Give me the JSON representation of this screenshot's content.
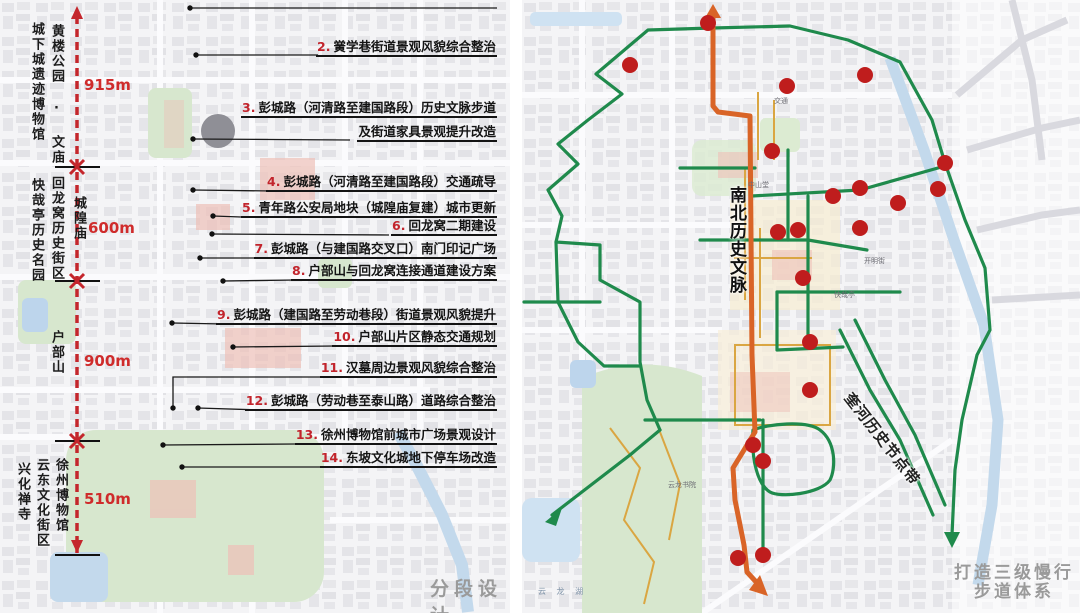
{
  "left_panel": {
    "caption": "分段设计",
    "segments": [
      {
        "label": "915m"
      },
      {
        "label": "600m"
      },
      {
        "label": "900m"
      },
      {
        "label": "510m"
      }
    ],
    "side_labels": [
      "城下城遗迹博物馆",
      "黄楼公园 · 文庙",
      "快哉亭历史名园",
      "回龙窝历史街区",
      "城隍庙",
      "户部山",
      "兴化禅寺",
      "云东文化街区",
      "徐州博物馆"
    ],
    "annotations": [
      {
        "num": "2.",
        "text": "黉学巷街道景观风貌综合整治"
      },
      {
        "num": "3.",
        "text": "彭城路（河清路至建国路段）历史文脉步道",
        "text2": "及街道家具景观提升改造"
      },
      {
        "num": "4.",
        "text": "彭城路（河清路至建国路段）交通疏导"
      },
      {
        "num": "5.",
        "text": "青年路公安局地块（城隍庙复建）城市更新"
      },
      {
        "num": "6.",
        "text": "回龙窝二期建设"
      },
      {
        "num": "7.",
        "text": "彭城路（与建国路交叉口）南门印记广场"
      },
      {
        "num": "8.",
        "text": "户部山与回龙窝连接通道建设方案"
      },
      {
        "num": "9.",
        "text": "彭城路（建国路至劳动巷段）街道景观风貌提升"
      },
      {
        "num": "10.",
        "text": "户部山片区静态交通规划"
      },
      {
        "num": "11.",
        "text": "汉墓周边景观风貌综合整治"
      },
      {
        "num": "12.",
        "text": "彭城路（劳动巷至泰山路）道路综合整治"
      },
      {
        "num": "13.",
        "text": "徐州博物馆前城市广场景观设计"
      },
      {
        "num": "14.",
        "text": "东坡文化城地下停车场改造"
      }
    ]
  },
  "right_panel": {
    "axis_label": "南北历史文脉",
    "corridor_label": "奎河历史节点带",
    "caption_line1": "打造三级慢行",
    "caption_line2": "步道体系",
    "map_labels": {
      "jiaotong": "交通",
      "zhongshantang": "中山堂",
      "kaimingjie": "开明街",
      "kuaizaiting": "快哉亭",
      "yunlongshuyuan": "云龙书院",
      "yunlonghu": "云 龙 湖"
    }
  },
  "colors": {
    "axis_red": "#c4262c",
    "route_orange": "#d96427",
    "route_green": "#1f8a4c",
    "node_red": "#bf1d1d",
    "park_green": "#d7e7ce",
    "water_blue": "#c3d9ec"
  }
}
